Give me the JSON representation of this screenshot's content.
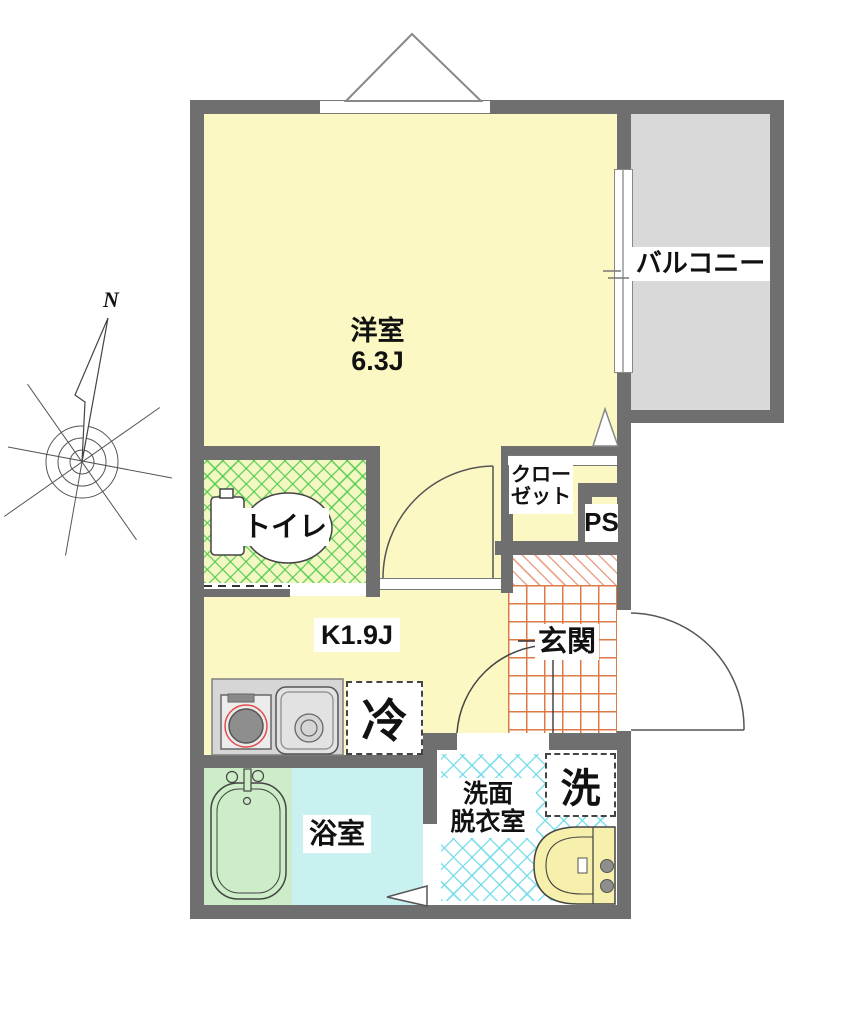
{
  "plan": {
    "compass": {
      "north_label": "N"
    },
    "rooms": {
      "western_room": {
        "name": "洋室",
        "size": "6.3J"
      },
      "balcony": {
        "name": "バルコニー"
      },
      "toilet": {
        "name": "トイレ"
      },
      "closet": {
        "name_line1": "クロー",
        "name_line2": "ゼット"
      },
      "pipe_space": {
        "name": "PS"
      },
      "kitchen": {
        "name": "K1.9J"
      },
      "entrance": {
        "name": "玄関"
      },
      "bathroom": {
        "name": "浴室"
      },
      "washroom": {
        "name_line1": "洗面",
        "name_line2": "脱衣室"
      }
    },
    "fixtures": {
      "refrigerator_label": "冷",
      "washing_machine_label": "洗"
    },
    "colors": {
      "wall_gray": "#6f6f6f",
      "room_yellow": "#fbf8c3",
      "balcony_gray": "#d9d9d9",
      "toilet_floor_green": "#f3f8c3",
      "bathroom_blue": "#c9f1ef",
      "tub_green": "#cdecc8",
      "entrance_grid_orange": "#dd7a46",
      "washroom_lattice_cyan": "#6edae8",
      "fixture_cream": "#f6f0ac",
      "stove_ring_red": "#e34c4c"
    }
  }
}
